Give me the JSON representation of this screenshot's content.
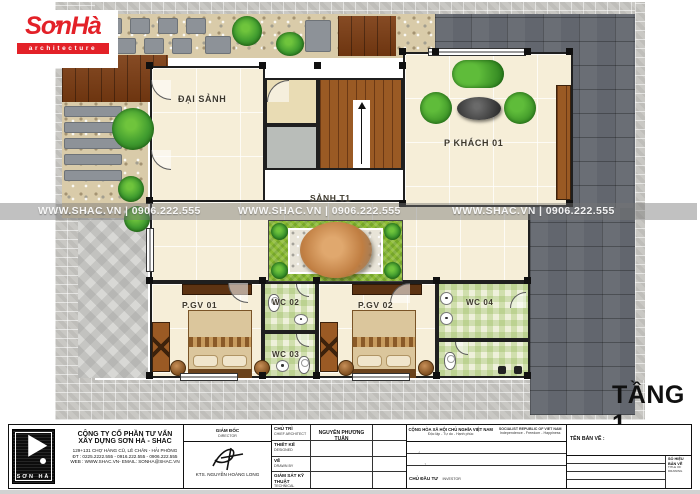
{
  "logo": {
    "name": "SơnHà",
    "tagline": "architecture",
    "accent_color": "#e32128"
  },
  "watermark": {
    "text": "WWW.SHAC.VN  |  0906.222.555"
  },
  "plan": {
    "floor_label": "TẦNG 1",
    "rooms": {
      "dai_sanh": "ĐẠI SẢNH",
      "p_khach_01": "P KHÁCH 01",
      "sanh_t1": "SẢNH T1",
      "p_gv_01": "P.GV 01",
      "wc_02": "WC 02",
      "wc_03": "WC 03",
      "p_gv_02": "P.GV 02",
      "wc_04": "WC 04"
    }
  },
  "title_block": {
    "logo_text": "SƠN HÀ",
    "company_line1": "CÔNG TY CỔ PHẦN TƯ VẤN",
    "company_line2": "XÂY DỰNG SƠN HÀ - SHAC",
    "address": "129+131 CHỢ HÀNG CŨ, LÊ CHÂN - HẢI PHÒNG",
    "phone": "ĐT : 0225.2222.555 - 0916.222.555 - 0906.222.555",
    "web": "WEB : WWW.SHAC.VN- EMAIL: SONHA@SHAC.VN",
    "director_vi": "GIÁM ĐỐC",
    "director_en": "DIRECTOR",
    "director_name": "KTS. NGUYỄN HOÀNG LONG",
    "rows": [
      {
        "vi": "CHỦ TRÌ",
        "en": "CHIEF ARCHITECT",
        "value": "NGUYỄN PHƯƠNG TUẤN"
      },
      {
        "vi": "THIẾT KẾ",
        "en": "DESIGNED",
        "value": ""
      },
      {
        "vi": "VẼ",
        "en": "DRAWN BY",
        "value": ""
      },
      {
        "vi": "GIÁM SÁT KỸ THUẬT",
        "en": "TECHNICAL MANAGER",
        "value": ""
      }
    ],
    "republic_vi_1": "CỘNG HÒA XÃ HỘI CHỦ NGHĨA VIỆT NAM",
    "republic_vi_2": "Độc lập - Tự do - Hạnh phúc",
    "republic_en_1": "SOCIALIST REPUBLIC OF VIET NAM",
    "republic_en_2": "Independence - Freedom - Happiness",
    "project_rows": [
      {
        "vi": "DỰ ÁN",
        "en": "PROJECT"
      },
      {
        "vi": "ĐỊA CHỈ",
        "en": "LOCATION"
      },
      {
        "vi": "CHỦ ĐẦU TƯ",
        "en": "INVESTOR"
      }
    ],
    "drawing_name_label": "TÊN BẢN VẼ :",
    "info_rows": [
      {
        "vi": "HẠNG MỤC",
        "en": "CATEGORY"
      },
      {
        "vi": "GIAI ĐOẠN THIẾT KẾ",
        "en": "DESIGN PHASE"
      },
      {
        "vi": "TỈ LỆ",
        "en": "SCALE"
      },
      {
        "vi": "HOÀN THÀNH",
        "en": "DATE"
      }
    ],
    "number_label_vi": "SỐ HIỆU BẢN VẼ",
    "number_label_en": "TITLE OF DRAWING"
  },
  "colors": {
    "wall": "#1f1f1f",
    "slate_paving": "#62666e",
    "interior_tile": "#f6eed8",
    "grass": "#8cbb33",
    "sofa_green": "#4da32f",
    "wood": "#9a5a24",
    "accent_red": "#e32128"
  }
}
